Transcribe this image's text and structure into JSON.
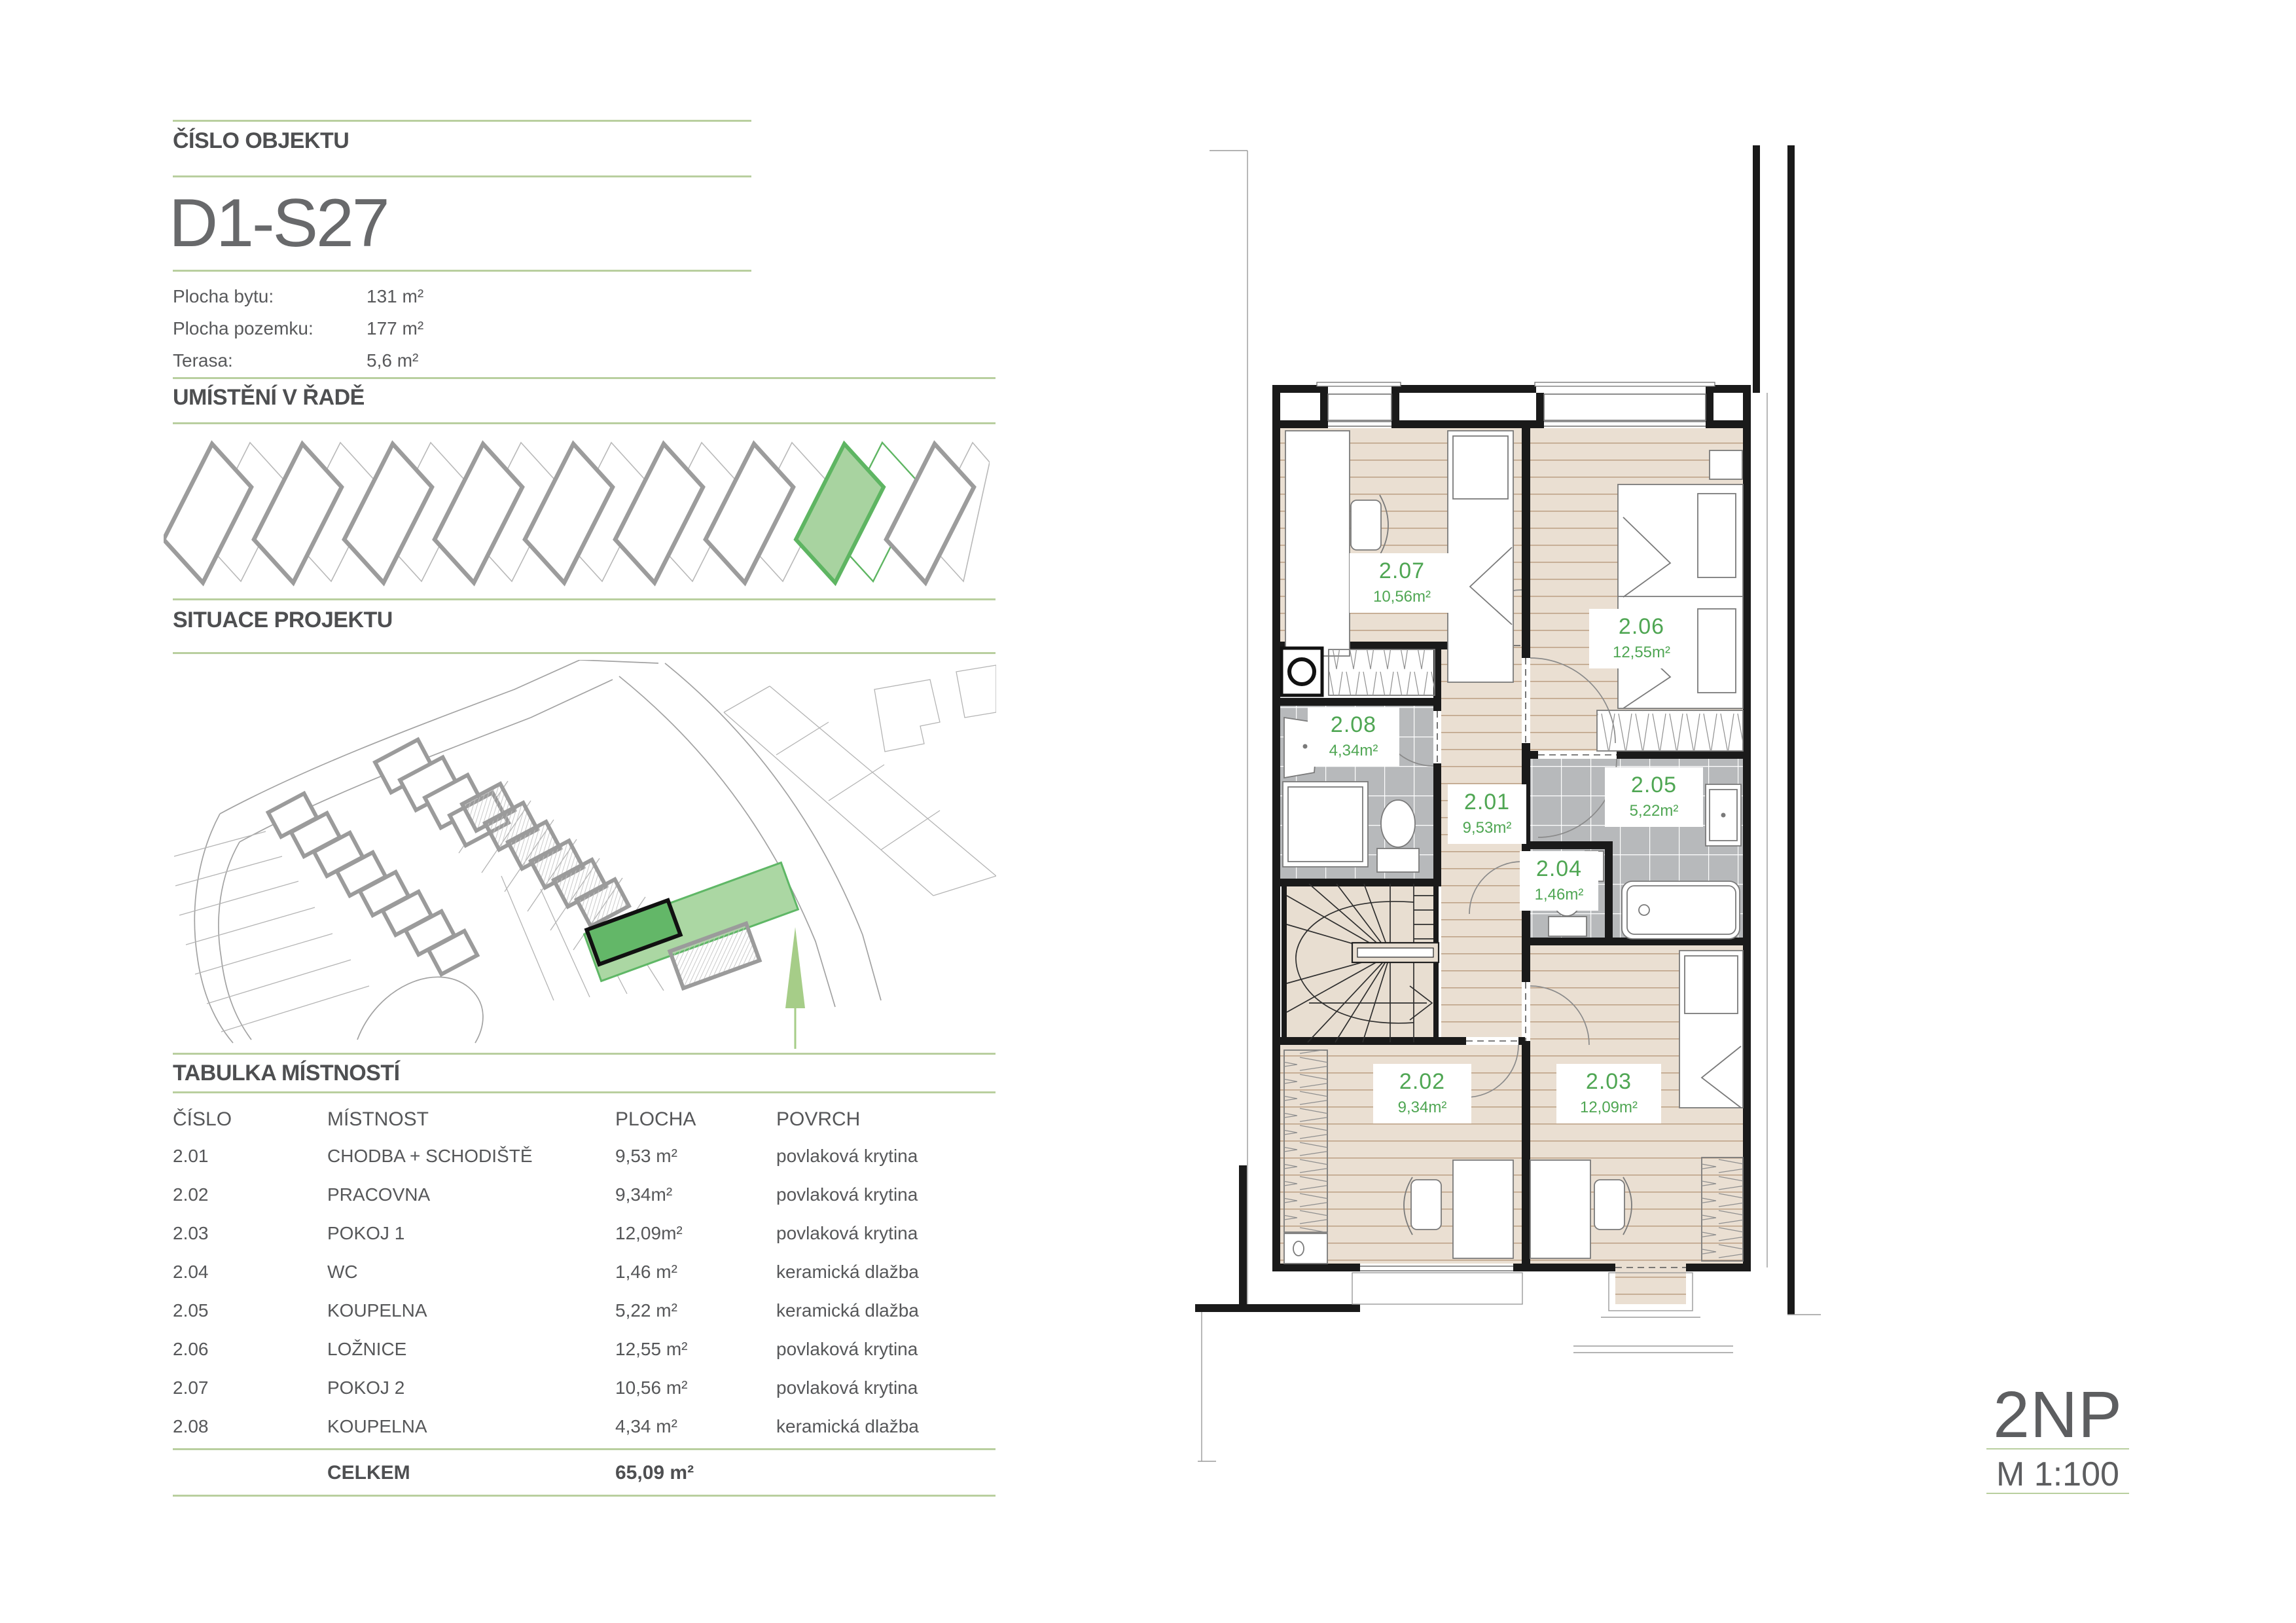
{
  "header": {
    "section_label": "ČÍSLO OBJEKTU",
    "object_id": "D1-S27",
    "details": [
      {
        "label": "Plocha bytu:",
        "value": "131 m²"
      },
      {
        "label": "Plocha pozemku:",
        "value": "177 m²"
      },
      {
        "label": "Terasa:",
        "value": "5,6 m²"
      }
    ]
  },
  "row_diagram": {
    "title": "UMÍSTĚNÍ V ŘADĚ",
    "units_total": 9,
    "highlighted_unit": 8
  },
  "situation": {
    "title": "SITUACE PROJEKTU"
  },
  "room_table": {
    "title": "TABULKA MÍSTNOSTÍ",
    "columns": {
      "number": "ČÍSLO",
      "name": "MÍSTNOST",
      "area": "PLOCHA",
      "surface": "POVRCH"
    },
    "rows": [
      {
        "number": "2.01",
        "name": "CHODBA + SCHODIŠTĚ",
        "area": "9,53 m²",
        "surface": "povlaková krytina"
      },
      {
        "number": "2.02",
        "name": "PRACOVNA",
        "area": "9,34m²",
        "surface": "povlaková krytina"
      },
      {
        "number": "2.03",
        "name": "POKOJ 1",
        "area": "12,09m²",
        "surface": "povlaková krytina"
      },
      {
        "number": "2.04",
        "name": "WC",
        "area": "1,46 m²",
        "surface": "keramická dlažba"
      },
      {
        "number": "2.05",
        "name": "KOUPELNA",
        "area": "5,22 m²",
        "surface": "keramická dlažba"
      },
      {
        "number": "2.06",
        "name": "LOŽNICE",
        "area": "12,55 m²",
        "surface": "povlaková krytina"
      },
      {
        "number": "2.07",
        "name": "POKOJ 2",
        "area": "10,56 m²",
        "surface": "povlaková krytina"
      },
      {
        "number": "2.08",
        "name": "KOUPELNA",
        "area": "4,34 m²",
        "surface": "keramická dlažba"
      }
    ],
    "total_label": "CELKEM",
    "total_area": "65,09 m²"
  },
  "floor_plan": {
    "rooms": [
      {
        "id": "2.01",
        "area": "9,53m²"
      },
      {
        "id": "2.02",
        "area": "9,34m²"
      },
      {
        "id": "2.03",
        "area": "12,09m²"
      },
      {
        "id": "2.04",
        "area": "1,46m²"
      },
      {
        "id": "2.05",
        "area": "5,22m²"
      },
      {
        "id": "2.06",
        "area": "12,55m²"
      },
      {
        "id": "2.07",
        "area": "10,56m²"
      },
      {
        "id": "2.08",
        "area": "4,34m²"
      }
    ]
  },
  "footer": {
    "floor_label": "2NP",
    "scale_label": "M 1:100"
  },
  "colors": {
    "accent_rule": "#b9cf9f",
    "heading_text": "#4e4f51",
    "body_text": "#58595b",
    "room_label_green": "#4fa653",
    "highlight_fill": "#a8d3a0",
    "highlight_stroke": "#5eb562",
    "site_house_green": "#63b768",
    "floor_wood": "#eadfd2",
    "floor_tile": "#b7b9bb",
    "wall": "#1a1a1a"
  }
}
